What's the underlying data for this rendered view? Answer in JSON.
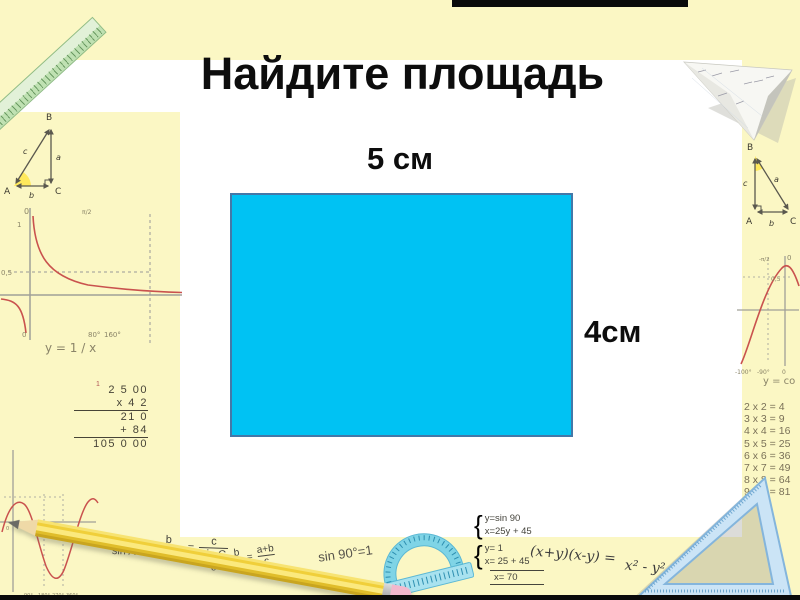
{
  "slide": {
    "title": "Найдите площадь",
    "width_label": "5 см",
    "height_label": "4см"
  },
  "colors": {
    "border_background": "#FBF7C4",
    "content_background": "#FFFFFF",
    "rectangle_fill": "#00C2F3",
    "rectangle_border": "#4478A8",
    "curve_red": "#C9524E",
    "decoration_green": "#BFE1B2",
    "decoration_blue": "#CBE4F6",
    "pencil_yellow": "#F0CF3A"
  },
  "decor": {
    "triangle_labels": {
      "A": "A",
      "B": "B",
      "C": "C",
      "a": "a",
      "b": "b",
      "c": "c"
    },
    "hyperbola": {
      "title": "y = 1 / x",
      "zero": "0",
      "one": "1",
      "half": "0,5",
      "pi_half": "π/2",
      "t80": "80°",
      "t160": "160°",
      "origin": "0"
    },
    "long_mult": {
      "carry": "1",
      "lines": [
        "2 5 00",
        "x 4 2",
        "21 0",
        "+ 84",
        "105 0 00"
      ]
    },
    "sine_graph": {
      "zero": "0",
      "t90": "90°",
      "t180": "180°",
      "t270": "270°",
      "t360": "360°"
    },
    "law_of_sines": {
      "n1": "a",
      "d1": "sin A",
      "n2": "b",
      "d2": "sin B",
      "n3": "c",
      "d3": "sin C",
      "eq": "="
    },
    "frac_sum": {
      "n1": "a",
      "d1": "c",
      "plus": "+",
      "n2": "b",
      "d2": "c",
      "eq": "=",
      "n3": "a+b",
      "d3": "c"
    },
    "sin_identity": "sin 90°=1",
    "system1": {
      "l1": "y=sin 90",
      "l2": "x=25y + 45"
    },
    "system2": {
      "l1": "y= 1",
      "l2": "x= 25 + 45",
      "result": "x= 70"
    },
    "identity_lhs": "(x+y)(x-y) =",
    "identity_rhs": "x² - y²",
    "cosine": {
      "title": "y = co",
      "pi_half": "-π/2",
      "zero": "0",
      "half": "0,5",
      "m100": "-100°",
      "m90": "-90°",
      "origin": "0"
    },
    "mult_table": {
      "rows": [
        "2 x 2 = 4",
        "3 x 3 = 9",
        "4 x 4 = 16",
        "5 x 5 = 25",
        "6 x 6 = 36",
        "7 x 7 = 49",
        "8 x 8 = 64",
        "9 x 9 = 81"
      ]
    }
  }
}
